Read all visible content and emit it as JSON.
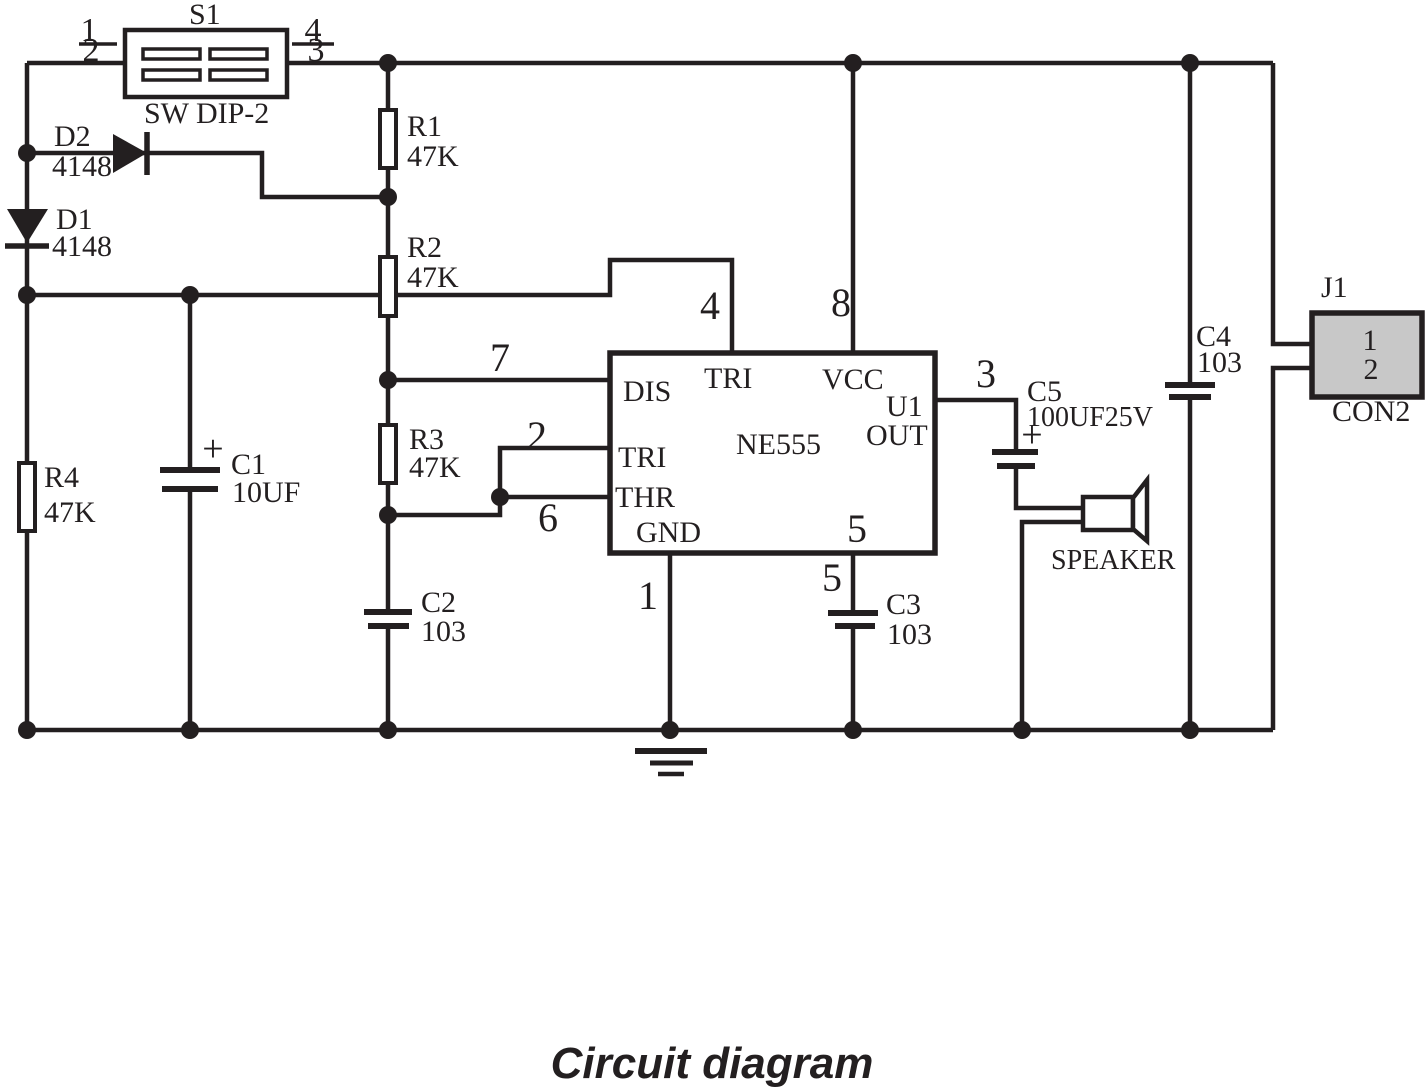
{
  "caption": "Circuit diagram",
  "colors": {
    "stroke": "#231f20",
    "connector_fill": "#c8c8c8",
    "background": "#ffffff"
  },
  "s1": {
    "ref": "S1",
    "part": "SW DIP-2",
    "pin1": "1",
    "pin2": "2",
    "pin3": "3",
    "pin4": "4"
  },
  "d2": {
    "ref": "D2",
    "value": "4148"
  },
  "d1": {
    "ref": "D1",
    "value": "4148"
  },
  "r1": {
    "ref": "R1",
    "value": "47K"
  },
  "r2": {
    "ref": "R2",
    "value": "47K"
  },
  "r3": {
    "ref": "R3",
    "value": "47K"
  },
  "r4": {
    "ref": "R4",
    "value": "47K"
  },
  "c1": {
    "ref": "C1",
    "value": "10UF",
    "polarity": "+"
  },
  "c2": {
    "ref": "C2",
    "value": "103"
  },
  "c3": {
    "ref": "C3",
    "value": "103"
  },
  "c4": {
    "ref": "C4",
    "value": "103"
  },
  "c5": {
    "ref": "C5",
    "value": "100UF25V",
    "polarity": "+"
  },
  "u1": {
    "ref": "U1",
    "part": "NE555",
    "pin_dis": "DIS",
    "pin_tri_top": "TRI",
    "pin_vcc": "VCC",
    "pin_tri": "TRI",
    "pin_thr": "THR",
    "pin_gnd": "GND",
    "pin_out": "OUT",
    "num_dis": "7",
    "num_tri": "2",
    "num_thr": "6",
    "num_reset": "4",
    "num_vcc": "8",
    "num_out": "3",
    "num_gnd": "1",
    "num_ctrl_inside": "5",
    "num_ctrl_outside": "5"
  },
  "speaker": {
    "label": "SPEAKER"
  },
  "j1": {
    "ref": "J1",
    "part": "CON2",
    "pin1": "1",
    "pin2": "2"
  }
}
